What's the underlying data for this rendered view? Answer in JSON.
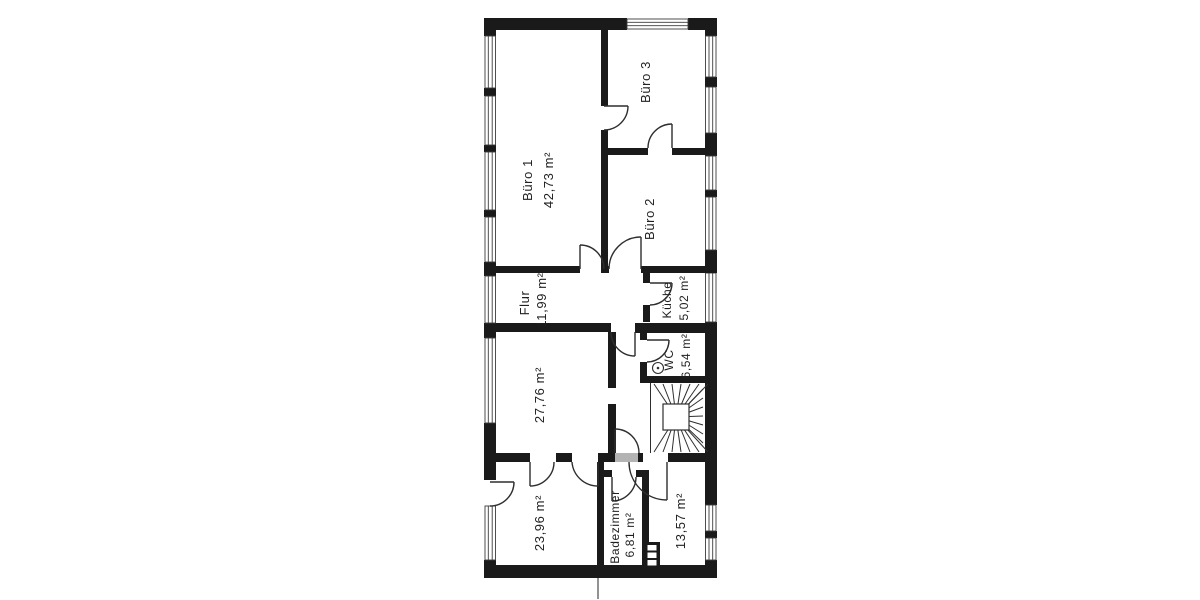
{
  "floor_plan": {
    "type": "floor-plan",
    "rooms": {
      "buero1": {
        "name": "Büro 1",
        "area": "42,73 m²"
      },
      "buero3": {
        "name": "Büro 3"
      },
      "buero2": {
        "name": "Büro 2"
      },
      "flur": {
        "name": "Flur",
        "area": "11,99 m²"
      },
      "kueche": {
        "name": "Küche",
        "area": "5,02 m²"
      },
      "wc": {
        "name": "WC",
        "area": "6,54 m²"
      },
      "zimmer_mitte_links": {
        "area": "27,76 m²"
      },
      "zimmer_unten_links": {
        "area": "23,96 m²"
      },
      "badezimmer": {
        "name": "Badezimmer",
        "area": "6,81 m²"
      },
      "zimmer_unten_rechts": {
        "area": "13,57 m²"
      }
    },
    "colors": {
      "wall": "#1a1a1a",
      "line": "#2e2e2e",
      "window_frame": "#3c3c3c",
      "light_wall": "#b3b3b3",
      "background": "#ffffff"
    }
  }
}
